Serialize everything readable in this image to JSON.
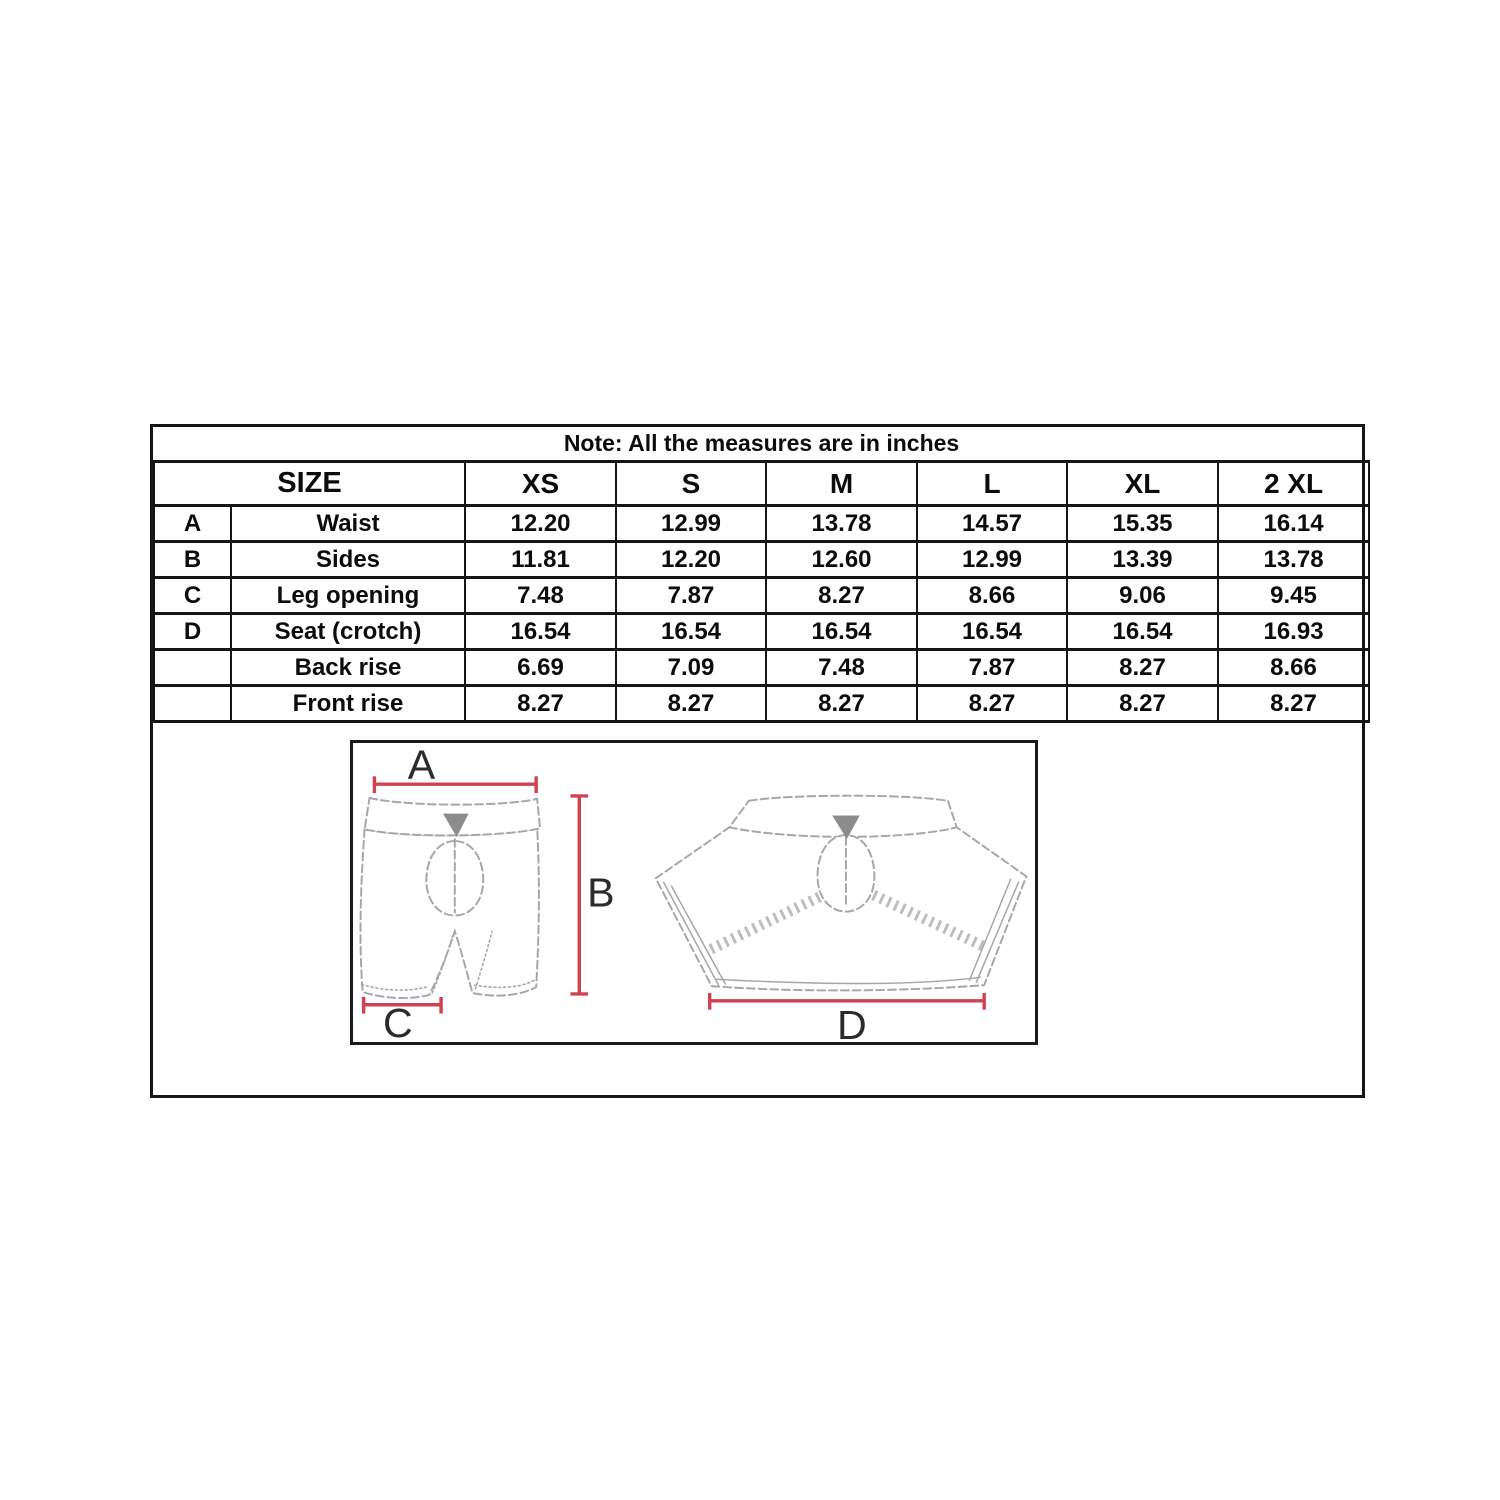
{
  "note": "Note: All the measures are in inches",
  "table": {
    "size_label": "SIZE",
    "size_columns": [
      "XS",
      "S",
      "M",
      "L",
      "XL",
      "2 XL"
    ],
    "rows": [
      {
        "key": "A",
        "label": "Waist",
        "values": [
          "12.20",
          "12.99",
          "13.78",
          "14.57",
          "15.35",
          "16.14"
        ]
      },
      {
        "key": "B",
        "label": "Sides",
        "values": [
          "11.81",
          "12.20",
          "12.60",
          "12.99",
          "13.39",
          "13.78"
        ]
      },
      {
        "key": "C",
        "label": "Leg opening",
        "values": [
          "7.48",
          "7.87",
          "8.27",
          "8.66",
          "9.06",
          "9.45"
        ]
      },
      {
        "key": "D",
        "label": "Seat (crotch)",
        "values": [
          "16.54",
          "16.54",
          "16.54",
          "16.54",
          "16.54",
          "16.93"
        ]
      },
      {
        "key": "",
        "label": "Back rise",
        "values": [
          "6.69",
          "7.09",
          "7.48",
          "7.87",
          "8.27",
          "8.66"
        ]
      },
      {
        "key": "",
        "label": "Front rise",
        "values": [
          "8.27",
          "8.27",
          "8.27",
          "8.27",
          "8.27",
          "8.27"
        ]
      }
    ]
  },
  "diagram": {
    "labels": {
      "waist": "A",
      "sides": "B",
      "leg_opening": "C",
      "seat": "D"
    },
    "colors": {
      "dimension_line": "#cf4350",
      "garment_outline": "#a6a6a6",
      "stitch_detail": "#bdbdbd",
      "logo": "#8c8c8c",
      "label_text": "#2b2b2b"
    }
  }
}
